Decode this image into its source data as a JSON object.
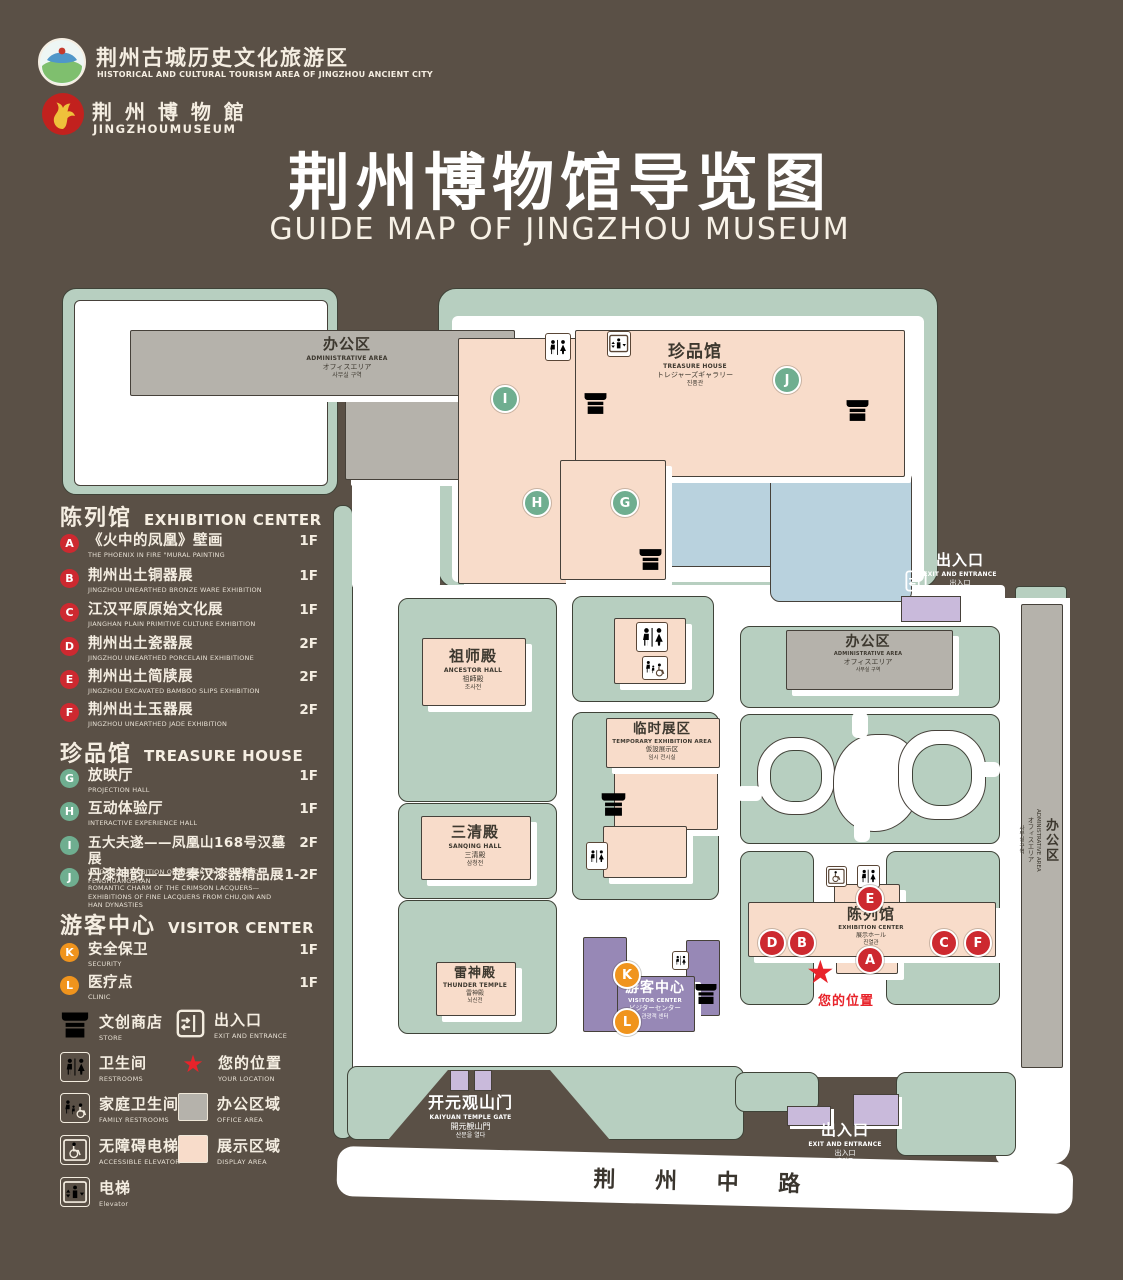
{
  "header": {
    "logo1": {
      "zh": "荆州古城历史文化旅游区",
      "en": "HISTORICAL AND CULTURAL TOURISM AREA OF JINGZHOU ANCIENT CITY"
    },
    "logo2": {
      "zh": "荆 州 博 物 館",
      "en": "JINGZHOUMUSEUM"
    },
    "title_zh": "荆州博物馆导览图",
    "title_en": "GUIDE MAP OF JINGZHOU MUSEUM"
  },
  "legend": {
    "sections": [
      {
        "zh": "陈列馆",
        "en": "EXHIBITION CENTER",
        "items": [
          {
            "key": "A",
            "zh": "《火中的凤凰》壁画",
            "en": "THE PHOENIX IN FIRE \"MURAL PAINTING",
            "floor": "1F"
          },
          {
            "key": "B",
            "zh": "荆州出土铜器展",
            "en": "JINGZHOU UNEARTHED BRONZE WARE EXHIBITION",
            "floor": "1F"
          },
          {
            "key": "C",
            "zh": "江汉平原原始文化展",
            "en": "JIANGHAN PLAIN PRIMITIVE CULTURE EXHIBITION",
            "floor": "1F"
          },
          {
            "key": "D",
            "zh": "荆州出土瓷器展",
            "en": "JINGZHOU UNEARTHED PORCELAIN EXHIBITIONE",
            "floor": "2F"
          },
          {
            "key": "E",
            "zh": "荆州出土简牍展",
            "en": "JINGZHOU EXCAVATED BAMBOO SLIPS EXHIBITION",
            "floor": "2F"
          },
          {
            "key": "F",
            "zh": "荆州出土玉器展",
            "en": "JINGZHOU UNEARTHED JADE EXHIBITION",
            "floor": "2F"
          }
        ]
      },
      {
        "zh": "珍品馆",
        "en": "TREASURE HOUSE",
        "items": [
          {
            "key": "G",
            "zh": "放映厅",
            "en": "PROJECTION HALL",
            "floor": "1F"
          },
          {
            "key": "H",
            "zh": "互动体验厅",
            "en": "INTERACTIVE EXPERIENCE HALL",
            "floor": "1F"
          },
          {
            "key": "I",
            "zh": "五大夫遂——凤凰山168号汉墓展",
            "en": "WUDAFU—EXHIBITION OF NO.168 HAN TOMB FROM FENGHUANGSHAN",
            "floor": "2F"
          },
          {
            "key": "J",
            "zh": "丹漆神韵——楚秦汉漆器精品展",
            "en": "ROMANTIC CHARM OF THE CRIMSON LACQUERS—EXHIBITIONS OF FINE LACQUERS FROM CHU,QIN AND HAN DYNASTIES",
            "floor": "1-2F"
          }
        ]
      },
      {
        "zh": "游客中心",
        "en": "VISITOR CENTER",
        "items": [
          {
            "key": "K",
            "zh": "安全保卫",
            "en": "SECURITY",
            "floor": "1F"
          },
          {
            "key": "L",
            "zh": "医疗点",
            "en": "CLINIC",
            "floor": "1F"
          }
        ]
      }
    ],
    "symbols": [
      {
        "zh": "文创商店",
        "en": "STORE"
      },
      {
        "zh": "出入口",
        "en": "EXIT AND ENTRANCE"
      },
      {
        "zh": "卫生间",
        "en": "RESTROOMS"
      },
      {
        "zh": "您的位置",
        "en": "YOUR LOCATION"
      },
      {
        "zh": "家庭卫生间",
        "en": "FAMILY RESTROOMS"
      },
      {
        "zh": "办公区域",
        "en": "OFFICE AREA"
      },
      {
        "zh": "无障碍电梯",
        "en": "ACCESSIBLE ELEVATOR"
      },
      {
        "zh": "展示区域",
        "en": "DISPLAY AREA"
      },
      {
        "zh": "电梯",
        "en": "Elevator"
      }
    ]
  },
  "map": {
    "buildings": {
      "admin": {
        "zh": "办公区",
        "en": "ADMINISTRATIVE AREA",
        "jp": "オフィスエリア",
        "kr": "사무실 구역"
      },
      "treasure": {
        "zh": "珍品馆",
        "en": "TREASURE HOUSE",
        "jp": "トレジャーズギャラリー",
        "kr": "진품관"
      },
      "ancestor": {
        "zh": "祖师殿",
        "en": "ANCESTOR HALL",
        "jp": "祖師殿",
        "kr": "조사전"
      },
      "temporary": {
        "zh": "临时展区",
        "en": "TEMPORARY EXHIBITION AREA",
        "jp": "仮設展示区",
        "kr": "임시 전시실"
      },
      "sanqing": {
        "zh": "三清殿",
        "en": "SANQING HALL",
        "jp": "三清殿",
        "kr": "삼청전"
      },
      "thunder": {
        "zh": "雷神殿",
        "en": "THUNDER TEMPLE",
        "jp": "雷神殿",
        "kr": "뇌신전"
      },
      "visitor": {
        "zh": "游客中心",
        "en": "VISITOR CENTER",
        "jp": "ビジターセンター",
        "kr": "관광객 센터"
      },
      "exhibition": {
        "zh": "陈列馆",
        "en": "EXHIBITION CENTER",
        "jp": "展示ホール",
        "kr": "진열관"
      },
      "gate": {
        "zh": "开元观山门",
        "en": "KAIYUAN TEMPLE GATE",
        "jp": "開元観山門",
        "kr": "산문을 열다"
      },
      "entrance": {
        "zh": "出入口",
        "en": "EXIT AND ENTRANCE",
        "jp": "出入口",
        "kr": "출입구"
      }
    },
    "road": "荆 州 中 路",
    "your_location": "您的位置",
    "marker_letters": {
      "A": "A",
      "B": "B",
      "C": "C",
      "D": "D",
      "E": "E",
      "F": "F",
      "G": "G",
      "H": "H",
      "I": "I",
      "J": "J",
      "K": "K",
      "L": "L"
    }
  },
  "colors": {
    "background": "#5a5046",
    "map_green": "#b7cfc0",
    "display_pink": "#f8dcca",
    "office_gray": "#b5b2ab",
    "pond_blue": "#b9d2de",
    "visitor_purple": "#9788b6",
    "marker_red": "#cd2930",
    "marker_green": "#6fae90",
    "marker_orange": "#f0941d",
    "location_red": "#e8232a"
  }
}
